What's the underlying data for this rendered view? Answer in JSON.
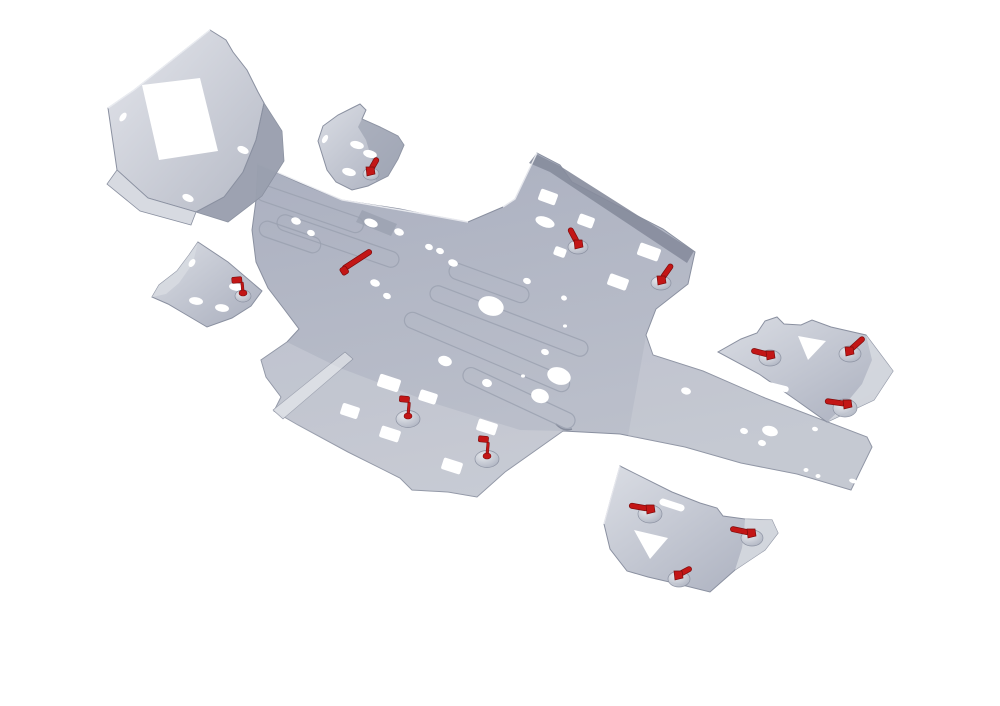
{
  "image": {
    "kind": "3d-product-render",
    "subject": "ATV aluminium skid plate kit with red quick-release fasteners",
    "background": "#ffffff"
  },
  "palette": {
    "background": "#ffffff",
    "metal": "#aeb3c2",
    "metal_light": "#d7dae1",
    "metal_mid": "#9aa0af",
    "metal_dark": "#868c9c",
    "edge": "#8a90a0",
    "edge_light": "#eef0f4",
    "hole": "#ffffff",
    "red": "#c31616",
    "red_dark": "#7e0b0b",
    "metal_grad_top": "#abb0c0",
    "metal_grad_bottom": "#bdc1cc",
    "face_hi": "#e3e5eb",
    "face_lo": "#b6bac6",
    "guard_hi": "#dadde4",
    "guard_lo": "#a9aebd",
    "boss_hi": "#e9ebef",
    "boss_lo": "#a6acbb"
  },
  "scene": {
    "width": 1000,
    "height": 706,
    "parts": [
      {
        "name": "main-skid-plate",
        "layers": [
          {
            "d": "M258,164 L300,183 L342,200 L400,209 L424,214 L468,222 L503,207 L515,199 L537,153 L560,165 L572,182 L616,205 L663,229 L695,252 L688,284 L656,309 L646,335 L653,355 L703,371 L765,398 L867,437 L872,447 L851,490 L797,474 L741,463 L685,447 L640,438 L620,434 L563,431 L505,472 L477,497 L448,492 L412,490 L400,478 L348,452 L298,425 L274,411 L281,397 L266,377 L261,360 L287,342 L299,329 L284,309 L268,288 L256,262 L252,230 L256,200 Z",
            "fill": "url(#gMain)",
            "stroke": "edge",
            "sw": 1
          },
          {
            "d": "M536,154 L560,166 L694,251 L687,263 L550,172 L529,163 Z",
            "fill": "metal_dark",
            "op": 0.9
          },
          {
            "d": "M362,210 L397,224 L391,236 L356,222 Z",
            "fill": "metal_mid",
            "op": 0.75
          },
          {
            "d": "M345,352 L353,359 L283,419 L273,410 Z",
            "fill": "metal_light",
            "stroke": "edge",
            "sw": 0.6,
            "op": 0.95
          },
          {
            "d": "M266,377 L281,397 L274,411 L299,426 L348,452 L400,478 L412,490 L448,492 L477,497 L505,472 L563,431 L520,430 L430,402 L340,368 L287,342 L261,360 Z",
            "fill": "#ffffff",
            "op": 0.16
          },
          {
            "d": "M646,336 L653,355 L703,371 L765,398 L867,437 L872,447 L851,490 L797,474 L741,463 L685,447 L640,438 L628,436 Z",
            "fill": "#ffffff",
            "op": 0.13
          },
          {
            "d": "M258,164 L342,200 L424,214 L468,222",
            "fill": "none",
            "stroke": "edge_light",
            "sw": 1.4,
            "op": 0.9
          },
          {
            "d": "M503,207 L515,199 L537,153",
            "fill": "none",
            "stroke": "edge_light",
            "sw": 1.4,
            "op": 0.9
          },
          {
            "d": "M556,424 Q563,432 572,429",
            "fill": "none",
            "stroke": "metal_dark",
            "sw": 1.5
          }
        ],
        "ribs": [
          {
            "cx": 310,
            "cy": 209,
            "w": 112,
            "rot": 19
          },
          {
            "cx": 290,
            "cy": 237,
            "w": 64,
            "rot": 19
          },
          {
            "cx": 338,
            "cy": 241,
            "w": 128,
            "rot": 19
          },
          {
            "cx": 489,
            "cy": 283,
            "w": 84,
            "rot": 20
          },
          {
            "cx": 509,
            "cy": 321,
            "w": 168,
            "rot": 21
          },
          {
            "cx": 487,
            "cy": 352,
            "w": 178,
            "rot": 23
          },
          {
            "cx": 519,
            "cy": 398,
            "w": 122,
            "rot": 25
          }
        ],
        "holes": [
          {
            "cx": 296,
            "cy": 221,
            "rx": 5,
            "ry": 3.5,
            "rot": 20
          },
          {
            "cx": 311,
            "cy": 233,
            "rx": 4,
            "ry": 3,
            "rot": 20
          },
          {
            "cx": 371,
            "cy": 223,
            "rx": 7,
            "ry": 4,
            "rot": 20
          },
          {
            "cx": 399,
            "cy": 232,
            "rx": 5,
            "ry": 3.5,
            "rot": 20
          },
          {
            "cx": 429,
            "cy": 247,
            "rx": 4,
            "ry": 3,
            "rot": 20
          },
          {
            "cx": 440,
            "cy": 251,
            "rx": 4,
            "ry": 3,
            "rot": 20
          },
          {
            "cx": 453,
            "cy": 263,
            "rx": 5,
            "ry": 3.5,
            "rot": 20
          },
          {
            "cx": 375,
            "cy": 283,
            "rx": 5,
            "ry": 3.5,
            "rot": 20
          },
          {
            "cx": 387,
            "cy": 296,
            "rx": 4,
            "ry": 3,
            "rot": 20
          },
          {
            "s": "r",
            "cx": 548,
            "cy": 197,
            "w": 18,
            "h": 12,
            "rot": 20
          },
          {
            "cx": 545,
            "cy": 222,
            "rx": 10,
            "ry": 5,
            "rot": 20
          },
          {
            "s": "r",
            "cx": 586,
            "cy": 221,
            "w": 16,
            "h": 11,
            "rot": 20
          },
          {
            "s": "r",
            "cx": 560,
            "cy": 252,
            "w": 12,
            "h": 9,
            "rot": 20
          },
          {
            "s": "r",
            "cx": 649,
            "cy": 252,
            "w": 22,
            "h": 13,
            "rot": 20
          },
          {
            "s": "r",
            "cx": 618,
            "cy": 282,
            "w": 20,
            "h": 12,
            "rot": 20
          },
          {
            "cx": 527,
            "cy": 281,
            "rx": 4,
            "ry": 3,
            "rot": 20
          },
          {
            "cx": 564,
            "cy": 298,
            "rx": 3,
            "ry": 2.5,
            "rot": 20
          },
          {
            "cx": 491,
            "cy": 306,
            "rx": 13,
            "ry": 9.5,
            "rot": 18
          },
          {
            "cx": 545,
            "cy": 352,
            "rx": 4,
            "ry": 3,
            "rot": 18
          },
          {
            "cx": 559,
            "cy": 376,
            "rx": 12,
            "ry": 8.5,
            "rot": 18
          },
          {
            "cx": 445,
            "cy": 361,
            "rx": 7,
            "ry": 5,
            "rot": 18
          },
          {
            "cx": 487,
            "cy": 383,
            "rx": 5,
            "ry": 4,
            "rot": 18
          },
          {
            "cx": 540,
            "cy": 396,
            "rx": 9,
            "ry": 7,
            "rot": 18
          },
          {
            "cx": 523,
            "cy": 376,
            "rx": 2,
            "ry": 1.6
          },
          {
            "cx": 565,
            "cy": 326,
            "rx": 2,
            "ry": 1.6
          },
          {
            "s": "r",
            "cx": 389,
            "cy": 383,
            "w": 22,
            "h": 13,
            "rot": 18
          },
          {
            "s": "r",
            "cx": 428,
            "cy": 397,
            "w": 18,
            "h": 11,
            "rot": 18
          },
          {
            "s": "r",
            "cx": 350,
            "cy": 411,
            "w": 18,
            "h": 12,
            "rot": 18
          },
          {
            "s": "r",
            "cx": 390,
            "cy": 434,
            "w": 20,
            "h": 12,
            "rot": 18
          },
          {
            "s": "r",
            "cx": 487,
            "cy": 427,
            "w": 20,
            "h": 12,
            "rot": 18
          },
          {
            "s": "r",
            "cx": 452,
            "cy": 466,
            "w": 20,
            "h": 12,
            "rot": 18
          },
          {
            "cx": 686,
            "cy": 391,
            "rx": 5,
            "ry": 3.5,
            "rot": 15
          },
          {
            "cx": 744,
            "cy": 431,
            "rx": 4,
            "ry": 3,
            "rot": 15
          },
          {
            "cx": 736,
            "cy": 466,
            "rx": 4,
            "ry": 3,
            "rot": 15
          },
          {
            "cx": 762,
            "cy": 443,
            "rx": 4,
            "ry": 3,
            "rot": 15
          },
          {
            "cx": 770,
            "cy": 431,
            "rx": 8,
            "ry": 5,
            "rot": 15
          },
          {
            "s": "r",
            "cx": 788,
            "cy": 387,
            "w": 16,
            "h": 5,
            "rot": 15
          },
          {
            "cx": 815,
            "cy": 429,
            "rx": 3,
            "ry": 2.2,
            "rot": 15
          },
          {
            "cx": 806,
            "cy": 470,
            "rx": 2.5,
            "ry": 2
          },
          {
            "cx": 818,
            "cy": 476,
            "rx": 2.5,
            "ry": 2
          },
          {
            "cx": 853,
            "cy": 481,
            "rx": 4,
            "ry": 2.2,
            "rot": 15
          },
          {
            "cx": 865,
            "cy": 486,
            "rx": 4,
            "ry": 2.2,
            "rot": 15
          }
        ]
      },
      {
        "name": "front-bumper-plate",
        "layers": [
          {
            "d": "M264,103 L282,131 L284,161 L262,196 L228,222 L196,212 L224,197 L243,172 L256,140 Z",
            "fill": "metal_mid",
            "stroke": "edge",
            "sw": 0.8,
            "op": 0.97
          },
          {
            "d": "M210,30 L226,40 L233,52 L247,70 L258,92 L264,103 L256,140 L243,172 L224,197 L196,212 L148,198 L117,170 L108,108 L134,90 Z",
            "fill": "url(#gFace)",
            "stroke": "edge",
            "sw": 1
          },
          {
            "d": "M117,170 L148,198 L196,212 L191,225 L140,211 L107,184 Z",
            "fill": "metal_light",
            "stroke": "edge",
            "sw": 0.8
          },
          {
            "d": "M264,103 L256,140 L243,172",
            "fill": "none",
            "stroke": "edge",
            "sw": 0.8,
            "op": 0.8
          },
          {
            "d": "M210,30 L134,90 L108,108",
            "fill": "none",
            "stroke": "edge_light",
            "sw": 1.4,
            "op": 0.95
          }
        ],
        "holes": [
          {
            "s": "p",
            "d": "M142,85 L200,78 L218,151 L159,160 Z"
          },
          {
            "cx": 123,
            "cy": 117,
            "rx": 5,
            "ry": 2.8,
            "rot": -55
          },
          {
            "cx": 243,
            "cy": 150,
            "rx": 6,
            "ry": 3.5,
            "rot": 25
          },
          {
            "cx": 188,
            "cy": 198,
            "rx": 6,
            "ry": 3.5,
            "rot": 25
          }
        ]
      },
      {
        "name": "front-a-arm-guard-right",
        "layers": [
          {
            "d": "M352,108 L360,104 L366,110 L362,119 L380,127 L398,136 L404,145 L398,159 L388,176 L368,186 L352,190 L336,182 L327,170 L318,141 L323,126 L338,115 Z",
            "fill": "url(#gGuard)",
            "stroke": "edge",
            "sw": 1
          },
          {
            "d": "M362,119 L380,127 L398,136 L404,145 L398,159 L388,176 L376,181 L372,160 L366,140 L358,127 Z",
            "fill": "metal_mid",
            "op": 0.65
          }
        ],
        "holes": [
          {
            "cx": 325,
            "cy": 139,
            "rx": 4.5,
            "ry": 2.5,
            "rot": -60
          },
          {
            "cx": 357,
            "cy": 145,
            "rx": 7,
            "ry": 3.8,
            "rot": 15
          },
          {
            "cx": 370,
            "cy": 154,
            "rx": 7,
            "ry": 3.8,
            "rot": 15
          },
          {
            "cx": 349,
            "cy": 172,
            "rx": 7,
            "ry": 3.8,
            "rot": 15
          }
        ]
      },
      {
        "name": "front-a-arm-guard-left",
        "layers": [
          {
            "d": "M198,242 L228,262 L262,291 L251,306 L232,318 L207,327 L185,314 L168,304 L152,297 L159,285 L177,271 L189,255 Z",
            "fill": "url(#gGuard)",
            "stroke": "edge",
            "sw": 1
          },
          {
            "d": "M152,297 L159,285 L177,271 L189,255 L198,242 L193,263 L179,283 L166,294 Z",
            "fill": "metal_light",
            "op": 0.9
          }
        ],
        "holes": [
          {
            "cx": 192,
            "cy": 263,
            "rx": 2.8,
            "ry": 4.5,
            "rot": 35
          },
          {
            "cx": 196,
            "cy": 301,
            "rx": 7,
            "ry": 3.8,
            "rot": 8
          },
          {
            "cx": 222,
            "cy": 308,
            "rx": 7,
            "ry": 3.8,
            "rot": 8
          },
          {
            "cx": 236,
            "cy": 287,
            "rx": 7,
            "ry": 3.8,
            "rot": 8
          }
        ]
      },
      {
        "name": "rear-a-arm-guard-right",
        "layers": [
          {
            "d": "M765,321 L777,317 L784,324 L801,325 L812,320 L831,327 L866,335 L893,371 L874,400 L827,422 L796,400 L759,374 L718,352 L741,339 L757,333 Z",
            "fill": "url(#gGuard)",
            "stroke": "edge",
            "sw": 1
          },
          {
            "d": "M866,335 L893,371 L874,400 L827,422 L843,407 L862,384 L872,360 Z",
            "fill": "metal_light",
            "op": 0.85
          }
        ],
        "holes": [
          {
            "s": "p",
            "d": "M798,336 L826,341 L808,360 Z"
          },
          {
            "s": "r",
            "cx": 777,
            "cy": 387,
            "w": 24,
            "h": 6,
            "rot": 14,
            "rx": 3
          }
        ]
      },
      {
        "name": "rear-a-arm-guard-bottom",
        "layers": [
          {
            "d": "M620,466 L672,492 L700,503 L717,508 L723,516 L745,519 L772,520 L778,533 L765,550 L735,570 L710,592 L678,584 L648,577 L627,571 L610,549 L604,524 L611,498 Z",
            "fill": "url(#gGuard)",
            "stroke": "edge",
            "sw": 1
          },
          {
            "d": "M745,519 L772,520 L778,533 L765,550 L735,570 L742,548 L744,532 Z",
            "fill": "metal_light",
            "op": 0.85
          },
          {
            "d": "M620,466 L611,498 L604,524",
            "fill": "none",
            "stroke": "edge_light",
            "sw": 1.3,
            "op": 0.9
          }
        ],
        "holes": [
          {
            "s": "r",
            "cx": 672,
            "cy": 505,
            "w": 26,
            "h": 7,
            "rot": 18,
            "rx": 3.5
          },
          {
            "s": "p",
            "d": "M634,530 L668,538 L650,559 Z"
          }
        ]
      }
    ],
    "bosses": [
      {
        "x": 578,
        "y": 247,
        "rx": 10,
        "ry": 7
      },
      {
        "x": 661,
        "y": 283,
        "rx": 10,
        "ry": 7
      },
      {
        "x": 408,
        "y": 419,
        "rx": 12,
        "ry": 8.5
      },
      {
        "x": 487,
        "y": 459,
        "rx": 12,
        "ry": 8.5
      },
      {
        "x": 770,
        "y": 358,
        "rx": 11,
        "ry": 8
      },
      {
        "x": 850,
        "y": 354,
        "rx": 11,
        "ry": 8
      },
      {
        "x": 845,
        "y": 408,
        "rx": 12,
        "ry": 9
      },
      {
        "x": 650,
        "y": 514,
        "rx": 12,
        "ry": 9
      },
      {
        "x": 752,
        "y": 538,
        "rx": 11,
        "ry": 8
      },
      {
        "x": 679,
        "y": 579,
        "rx": 11,
        "ry": 8
      },
      {
        "x": 371,
        "y": 174,
        "rx": 8,
        "ry": 6
      },
      {
        "x": 243,
        "y": 296,
        "rx": 8,
        "ry": 6
      }
    ],
    "fasteners": [
      {
        "name": "front-right-guard-clip",
        "type": "lever",
        "x": 370,
        "y": 171,
        "angle": -60,
        "len": 13
      },
      {
        "name": "front-left-guard-clip",
        "type": "flag",
        "x": 243,
        "y": 293,
        "angle": -5,
        "len": 11
      },
      {
        "name": "center-quick-pin",
        "type": "pin",
        "x": 357,
        "y": 260,
        "angle": -33,
        "len": 34
      },
      {
        "name": "front-right-wing-lever-a",
        "type": "lever",
        "x": 578,
        "y": 244,
        "angle": -118,
        "len": 16
      },
      {
        "name": "front-right-wing-lever-b",
        "type": "lever",
        "x": 661,
        "y": 280,
        "angle": -55,
        "len": 17
      },
      {
        "name": "left-wing-flag-a",
        "type": "flag",
        "x": 408,
        "y": 416,
        "angle": 5,
        "len": 14
      },
      {
        "name": "left-wing-flag-b",
        "type": "flag",
        "x": 487,
        "y": 456,
        "angle": 5,
        "len": 14
      },
      {
        "name": "rear-right-guard-lever-a",
        "type": "lever",
        "x": 770,
        "y": 355,
        "angle": 194,
        "len": 17
      },
      {
        "name": "rear-right-guard-lever-b",
        "type": "lever",
        "x": 849,
        "y": 351,
        "angle": -42,
        "len": 18
      },
      {
        "name": "rear-right-guard-lever-c",
        "type": "lever",
        "x": 847,
        "y": 404,
        "angle": 188,
        "len": 20
      },
      {
        "name": "rear-bottom-guard-lever-a",
        "type": "lever",
        "x": 650,
        "y": 509,
        "angle": 190,
        "len": 19
      },
      {
        "name": "rear-bottom-guard-lever-b",
        "type": "lever",
        "x": 751,
        "y": 533,
        "angle": 192,
        "len": 19
      },
      {
        "name": "rear-bottom-guard-lever-c",
        "type": "lever",
        "x": 678,
        "y": 575,
        "angle": -28,
        "len": 13
      }
    ]
  }
}
